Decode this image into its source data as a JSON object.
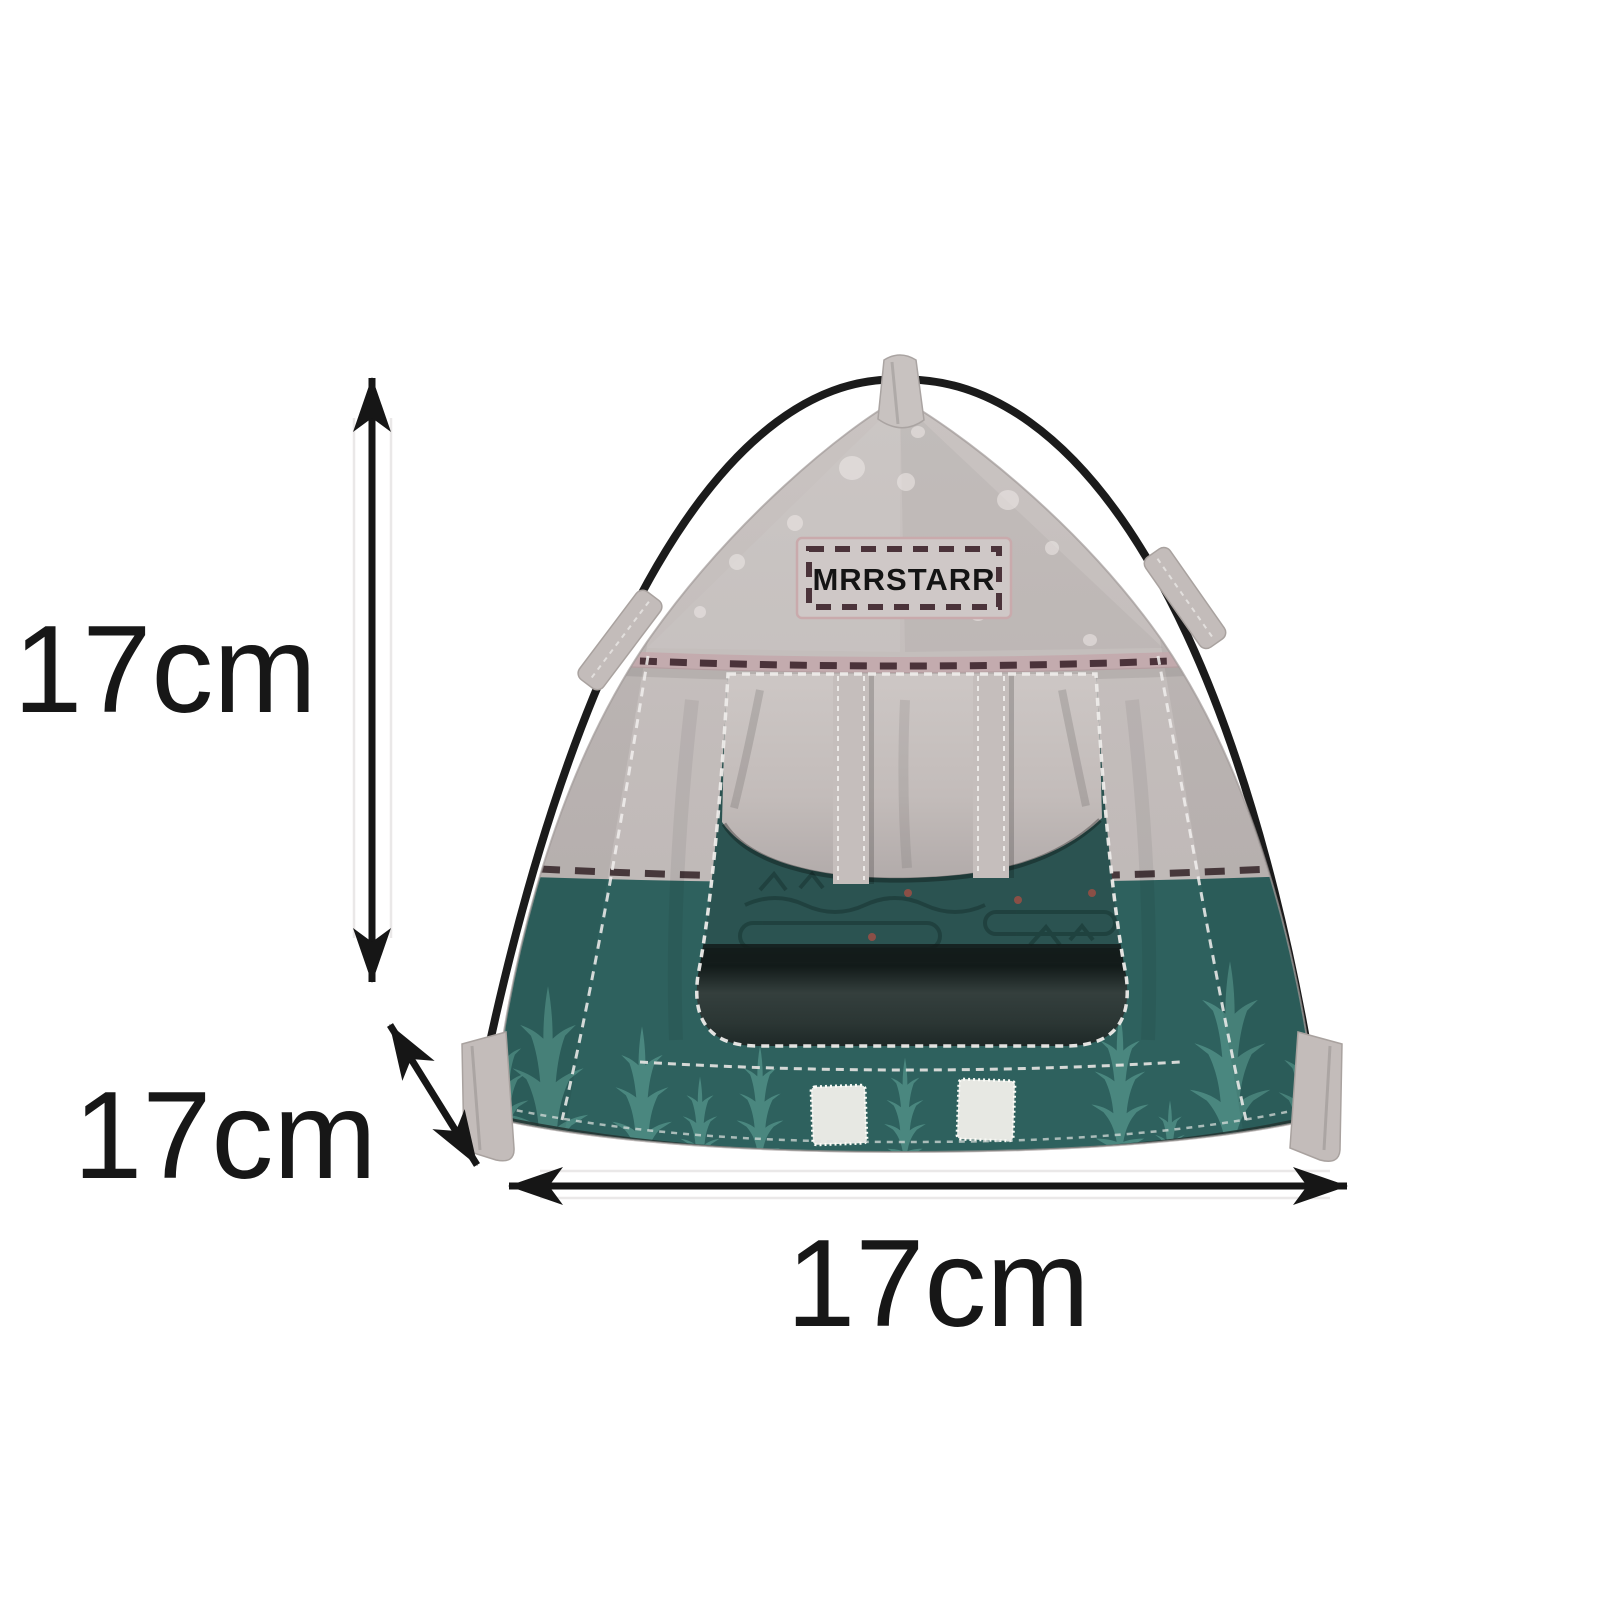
{
  "diagram": {
    "brand_patch": {
      "text": "MRRSTARR"
    },
    "dimensions": {
      "height_label": "17cm",
      "depth_label": "17cm",
      "width_label": "17cm"
    },
    "colors": {
      "canopy_gray": "#c2bbba",
      "canopy_light": "#cdc7c5",
      "base_teal": "#2e615e",
      "tree_teal": "#4e8c84",
      "interior_teal": "#2b5351",
      "floor_dark": "#232e2c",
      "pole_black": "#1b1b1b",
      "stitch_brown": "#4b333a",
      "tape_pink": "#c3a9ac",
      "velcro_white": "#e7e8e3",
      "arrow_black": "#161616",
      "background": "#ffffff"
    }
  }
}
